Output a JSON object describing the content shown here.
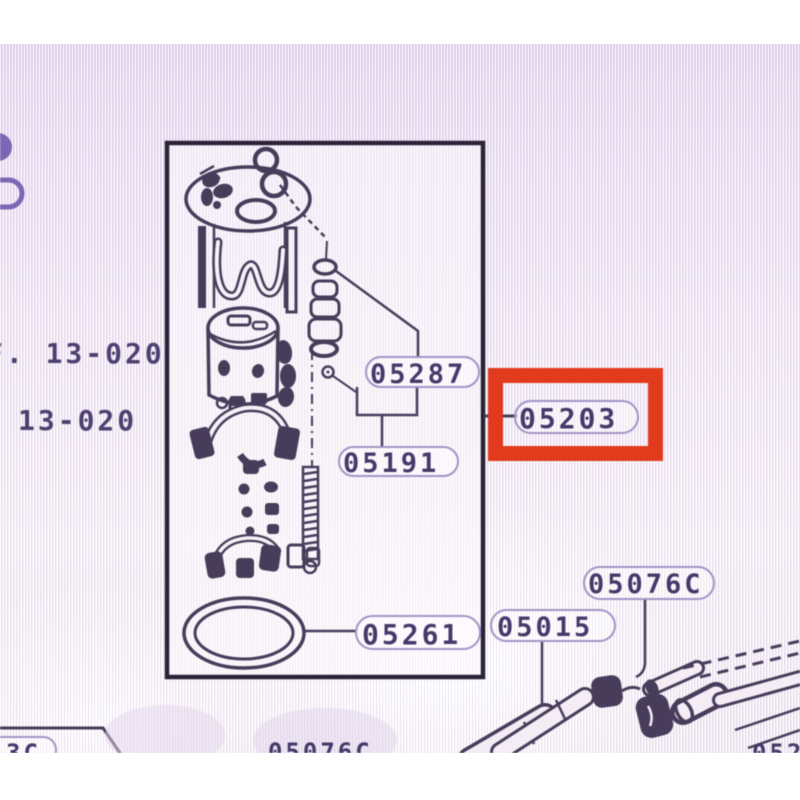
{
  "margin": {
    "ref_line1": "F. 13-020",
    "ref_line2": "13-020"
  },
  "labels": {
    "p05287": "05287",
    "p05191": "05191",
    "p05203": "05203",
    "p05261": "05261",
    "p05015": "05015",
    "p05076c": "05076C",
    "partial_bottom_left": "3C",
    "partial_bottom_center": "05076C",
    "partial_bottom_right": "052"
  },
  "highlight": {
    "part_number": "05203",
    "box_color": "#e23a1d"
  },
  "colors": {
    "ink": "#473c5a",
    "label_text": "#45396a",
    "oval_stroke": "#a393c6",
    "margin_text": "#4d4070",
    "screen_tint_top": "#e6d7ee",
    "screen_tint_bottom": "#f5eff6"
  }
}
